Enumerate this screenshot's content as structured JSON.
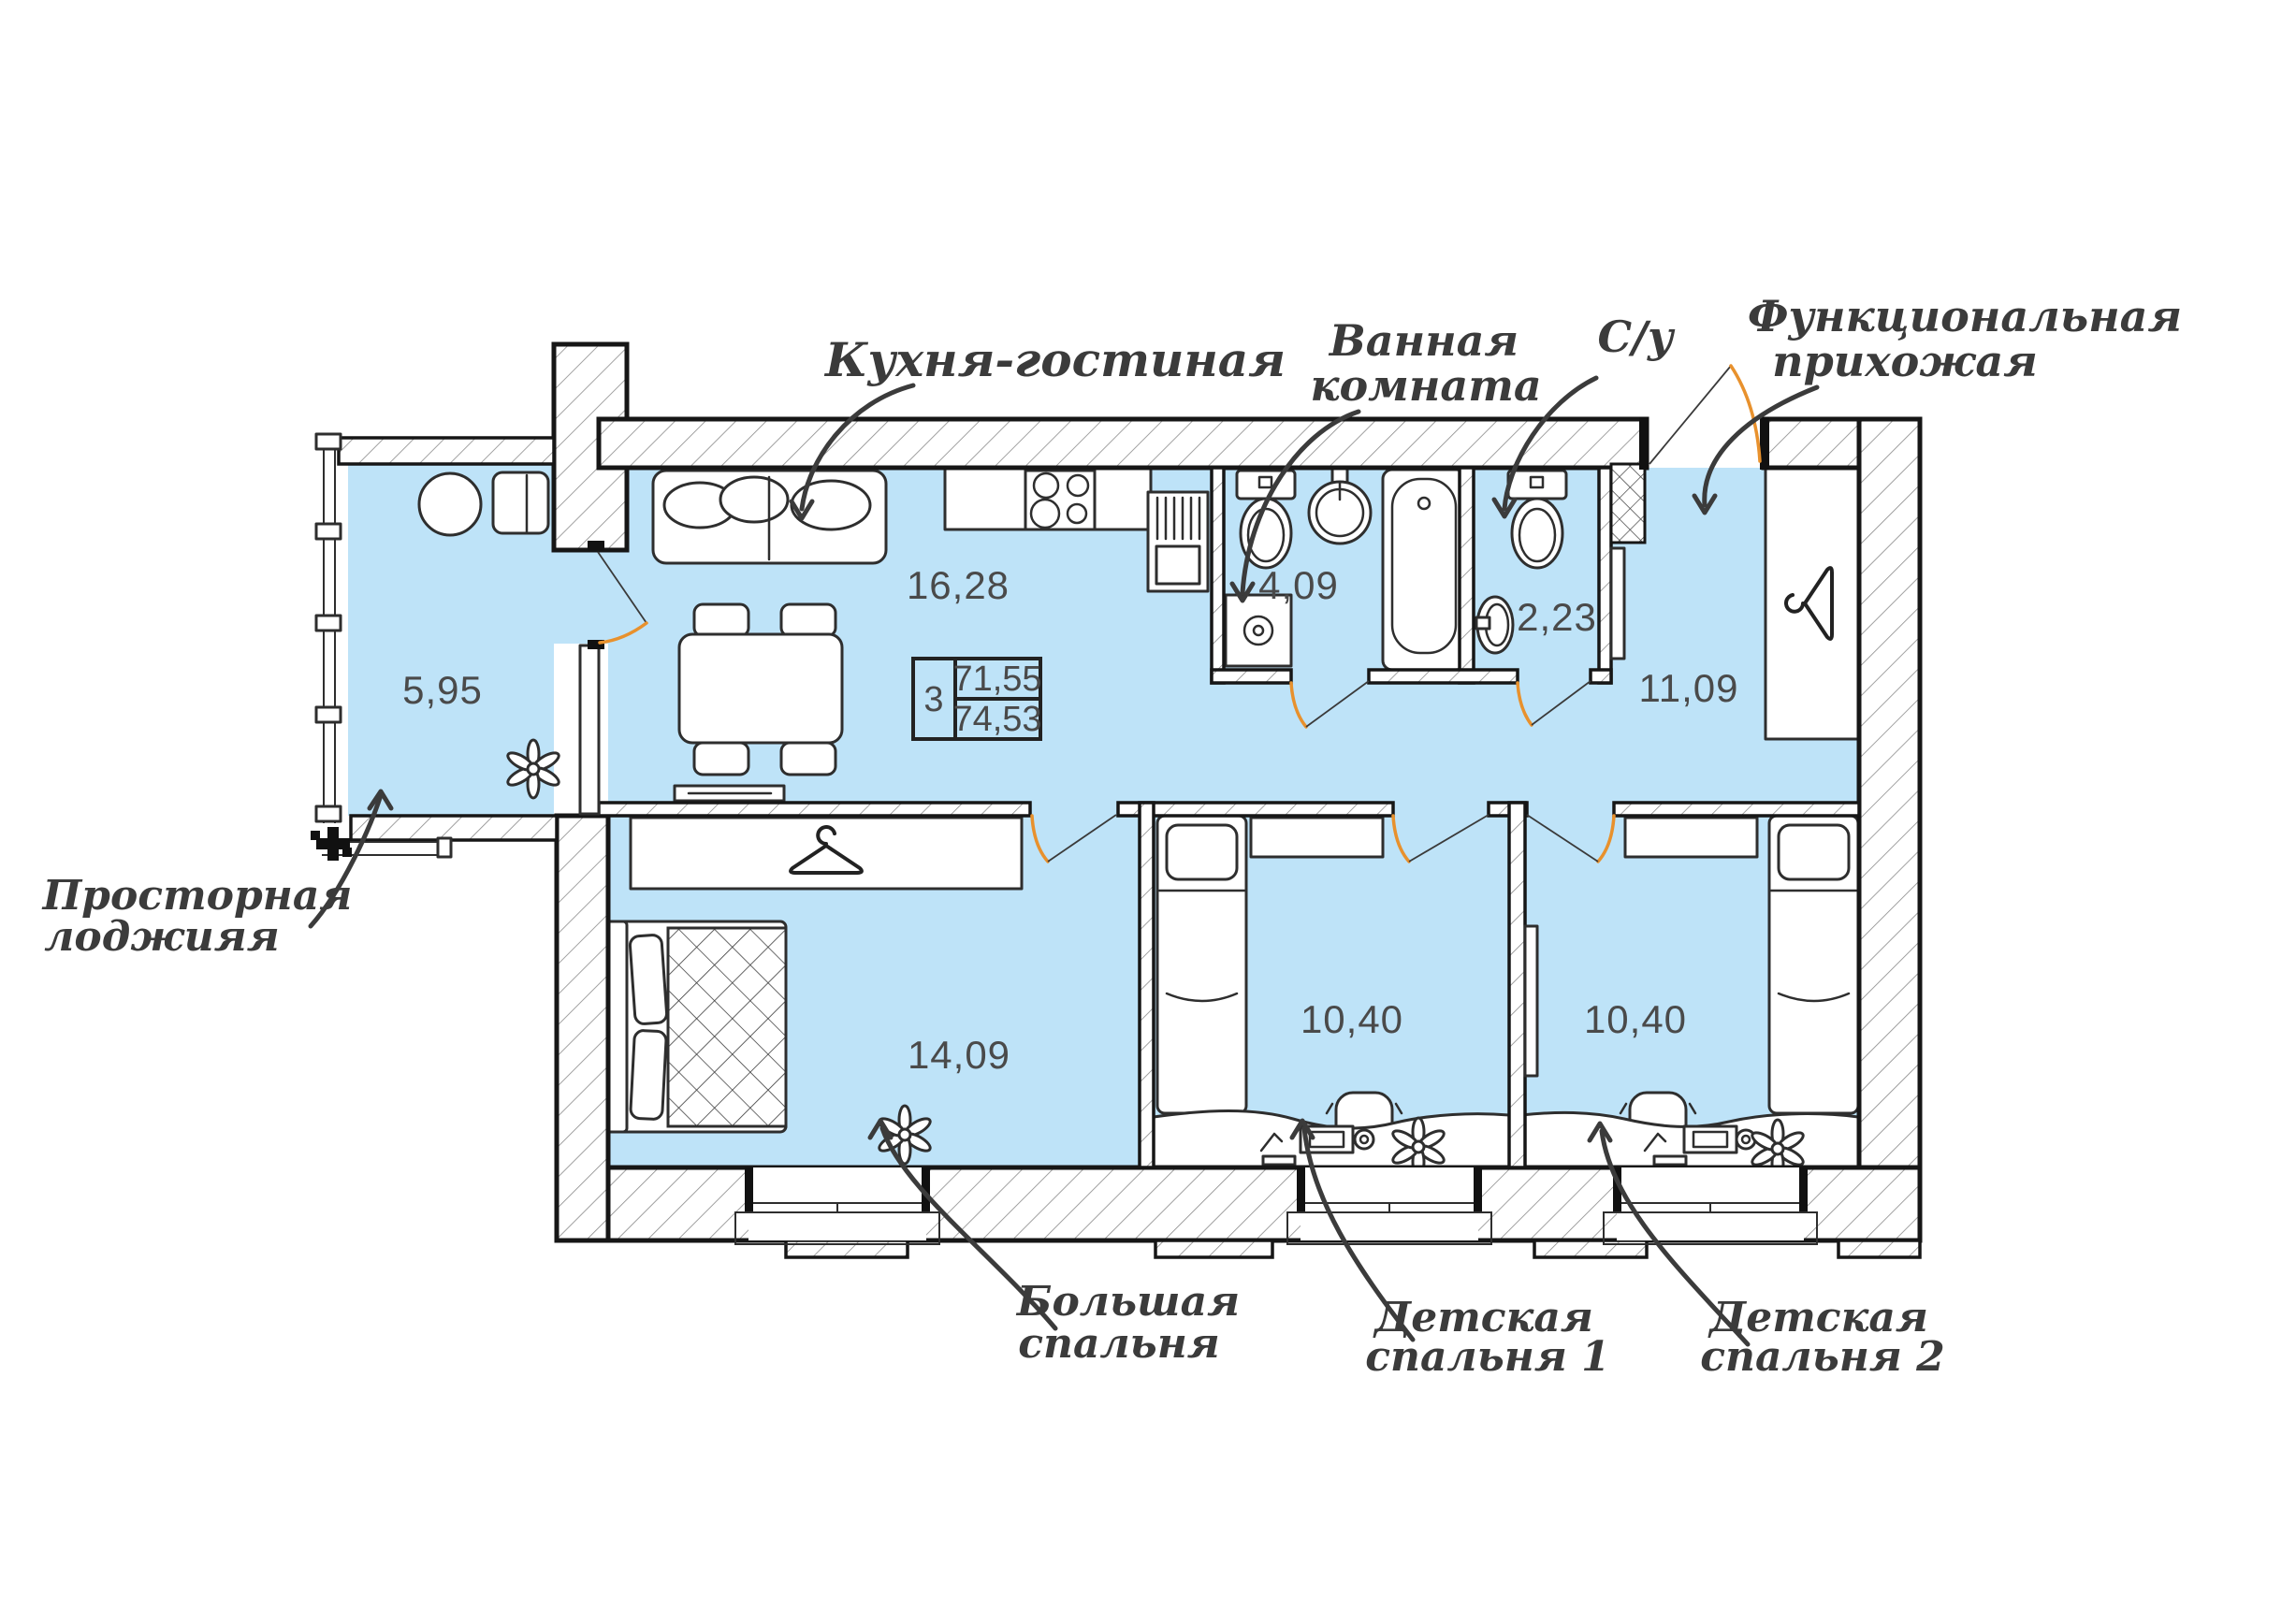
{
  "info_box": {
    "rooms_count": "3",
    "living_area": "71,55",
    "total_area": "74,53"
  },
  "rooms": {
    "loggia": {
      "area": "5,95",
      "label1": "Просторная",
      "label2": "лоджияя"
    },
    "kitchen_living": {
      "area": "16,28",
      "label1": "Кухня-гостиная",
      "label2": ""
    },
    "bathroom": {
      "area": "4,09",
      "label1": "Ванная",
      "label2": "комната"
    },
    "wc": {
      "area": "2,23",
      "label1": "С/у",
      "label2": ""
    },
    "hallway": {
      "area": "11,09",
      "label1": "Функциональная",
      "label2": "прихожая"
    },
    "bedroom_master": {
      "area": "14,09",
      "label1": "Большая",
      "label2": "спальня"
    },
    "bedroom_kids1": {
      "area": "10,40",
      "label1": "Детская",
      "label2": "спальня 1"
    },
    "bedroom_kids2": {
      "area": "10,40",
      "label1": "Детская",
      "label2": "спальня 2"
    }
  },
  "icons": {
    "plant": "flower-icon",
    "wardrobe_hanger": "hanger-icon",
    "section_marker": "cross-icon"
  },
  "colors": {
    "floor": "#BEE3F8",
    "door_arc": "#E8912D",
    "ink": "#3B3B3B",
    "wall_line": "#161616",
    "number": "#4A4A4A"
  }
}
